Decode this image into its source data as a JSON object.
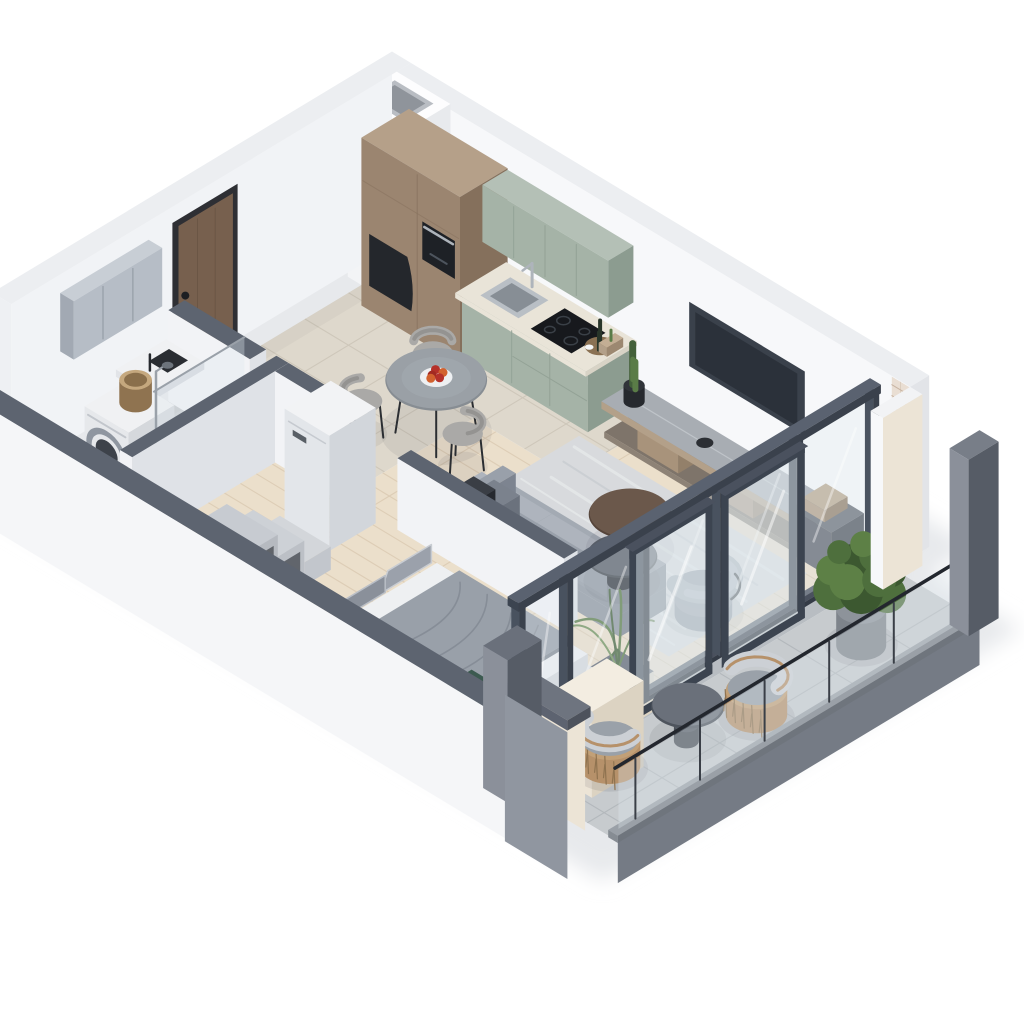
{
  "meta": {
    "kind": "isometric-3d-floor-plan-render",
    "description": "Cutaway 3D isometric render of a studio apartment with kitchen, dining area, living room, bedroom nook, bathroom and glazed balcony",
    "background": "#ffffff",
    "camera": "isometric",
    "visible_text": ""
  },
  "palette": {
    "bg": "#ffffff",
    "shadow": "#e7e9ec",
    "wallTop": "#eceef1",
    "wallNE": "#f7f8fa",
    "wallNW": "#f1f3f6",
    "wallEnd": "#e2e4e8",
    "grayTop": "#5d6470",
    "partFace": "#f2f3f6",
    "partSide": "#dfe2e7",
    "swWhite": "#f5f6f8",
    "tile": "#ded8cc",
    "tileLine": "#cec7ba",
    "bath": "#c9ccd0",
    "bathLine": "#b9bdc2",
    "wood": "#ebdfcb",
    "woodLine": "#ddcdb6",
    "paver": "#c7cbce",
    "paverLine": "#b3b8bc",
    "thresh": "#b8bdc2",
    "rugMain": "#d8dadd",
    "rugLight": "#e6e8ea",
    "rugDark": "#c8ccd1",
    "rugBed": "#dddfe2",
    "doorFrame": "#2e2f34",
    "doorWood": "#77604e",
    "doorGrain": "#64503f",
    "woodCab": "#9b8570",
    "woodCabSide": "#85705c",
    "woodCabTop": "#b5a089",
    "ovenBlack": "#1e2126",
    "nicheDark": "#24272c",
    "steelHandle": "#aeb4bb",
    "green": "#a5b3a7",
    "greenSide": "#8c9c90",
    "greenLine": "#93a296",
    "counterTop": "#e9e4d8",
    "counterSide": "#d8d3c6",
    "sinkSteel": "#b9bfc5",
    "sinkInner": "#878e95",
    "hobBlack": "#17191d",
    "hobRing": "#3a4047",
    "trayWood": "#8a7153",
    "bottleGreen": "#28352a",
    "plantGreen": "#5a7c47",
    "plantDark": "#43603a",
    "plantLight": "#6f9058",
    "standTop": "#a8adb3",
    "standWoodC": "#b3a089",
    "standShadow": "#56514b",
    "standPlinth": "#7e746a",
    "benchDark": "#5f646e",
    "tvPanel": "#3a414b",
    "tvScreen": "#2b313a",
    "sofaBase": "#8e959f",
    "sofaCushion": "#a3aab3",
    "sofaBack": "#aeb4bd",
    "sofaDark": "#7b828d",
    "cubeBlack": "#2f3339",
    "tblBrownTop": "#6b584b",
    "tblBrownSide": "#55443a",
    "tblDarkTop": "#585e68",
    "tblDarkSide": "#43484f",
    "chairShell": "#aaa9a7",
    "chairSide": "#949391",
    "legBlack": "#2b2e32",
    "bedFrame": "#d6d8dc",
    "mattress": "#eef0f2",
    "duvet": "#99a0a9",
    "duvetShade": "#848b95",
    "pillowA": "#9ba1ab",
    "pillowB": "#8a909a",
    "throwGreen": "#3c5a50",
    "glassFrame": "#3c4450",
    "glassPost": "#49525f",
    "glassPane": "#dfe9ee",
    "glassShine": "#ffffff",
    "railDark": "#23272e",
    "railBase": "#868c93",
    "slabFace": "#757b85",
    "fridgeFace": "#e3e6ea",
    "fridgeSide": "#d2d6db",
    "fridgeTop": "#f2f3f5",
    "fridgeLogo": "#595f66",
    "washerFace": "#e6e8eb",
    "washerSide": "#d5d8dc",
    "washerTop": "#f0f1f3",
    "washerRing": "#8f96a0",
    "washerGlass": "#3d424a",
    "mirrorFace": "#b6bdc6",
    "mirrorSide": "#a2a9b3",
    "mirrorTop": "#c8ced5",
    "tubWhite": "#f1f2f4",
    "tubInner": "#ccd0d4",
    "showerChrome": "#9aa1a9",
    "basketTan": "#c5a87e",
    "basketDark": "#a3act7",
    "cream": "#ece4d6",
    "creamSide": "#dcd3c2",
    "creamTop": "#f3ede1",
    "brickBg": "#e9ded3",
    "brickLine": "#c8b4a2",
    "pillarLight": "#8b909a",
    "pillarMid": "#6e747e",
    "pillarDark": "#565c66",
    "potBlack": "#303439",
    "potGray": "#8d939a",
    "bush1": "#4e6f3d",
    "bush2": "#5d8046",
    "bush3": "#3c5830",
    "rattanC": "#b6916a",
    "rattanD": "#8f7350",
    "cushA": "#ccd0d5",
    "cushB": "#9aa1a9",
    "plate": "#eef0f2",
    "appleA": "#b5312a",
    "appleB": "#d2622f",
    "ao": "#30343a"
  },
  "rooms": [
    {
      "name": "kitchen",
      "floor": "beige stone tile",
      "items": [
        "tall wood cabinet with built-in oven",
        "curved dark display niche",
        "sage green upper cabinets",
        "sage green base units",
        "stainless sink with faucet",
        "black induction hob",
        "wood serving tray with bottles",
        "corner ventilation shaft"
      ]
    },
    {
      "name": "dining-area",
      "floor": "light wood",
      "items": [
        "round stone-top table with black legs",
        "three upholstered chairs",
        "plate of apples"
      ]
    },
    {
      "name": "living-room",
      "floor": "light wood",
      "items": [
        "gray fabric sofa",
        "black cube side table",
        "brown round coffee table",
        "dark gray round coffee table",
        "round swivel armchair",
        "mottled gray rug",
        "wall-mounted tv",
        "long wood media bench with stone top",
        "dark gray storage cabinet",
        "potted cactus",
        "potted palm"
      ]
    },
    {
      "name": "bedroom-nook",
      "floor": "light wood",
      "items": [
        "double bed with gray duvet",
        "gray pillows",
        "dark green throw",
        "white nightstand",
        "pale patterned rug",
        "white partition wall behind sofa",
        "fridge cabinet",
        "stepped storage shelf"
      ]
    },
    {
      "name": "hallway",
      "floor": "beige stone tile",
      "items": [
        "brown entry door with black frame"
      ]
    },
    {
      "name": "bathroom",
      "floor": "gray tile",
      "items": [
        "washing machine",
        "wicker basket",
        "white counter with black basin",
        "gray mirror cabinet",
        "shower with glass screen and chrome riser",
        "white bathtub"
      ]
    },
    {
      "name": "balcony",
      "floor": "concrete pavers",
      "items": [
        "two rattan armchairs with gray cushions",
        "round pedestal side table",
        "large potted shrub",
        "cream storage cabinets",
        "glass balustrade with dark handrail",
        "dark framed sliding glass doors",
        "white brick pier",
        "gray corner pillars"
      ]
    }
  ]
}
